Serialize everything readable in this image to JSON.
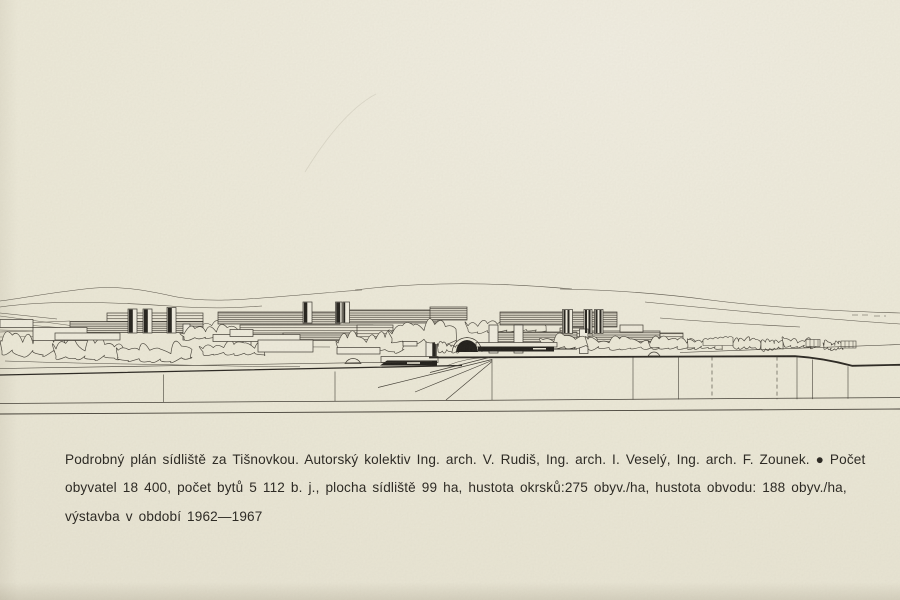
{
  "page": {
    "kind": "book page with architectural drawing",
    "drawing_alt": "Panoramic line drawing of a housing estate: long slab apartment blocks and striped tower blocks among trees, hills in the background, elevated road and retaining wall in the foreground",
    "caption": {
      "line1": "Podrobný plán sídliště za Tišnovkou. Autorský kolektiv Ing. arch. V. Rudiš, Ing. arch. I. Veselý, Ing. arch. F. Zounek. ● Počet",
      "line2": "obyvatel 18 400, počet bytů 5 112 b. j., plocha sídliště 99 ha, hustota okrsků:275 obyv./ha, hustota obvodu: 188 obyv./ha,",
      "line3": "výstavba v období 1962—1967"
    },
    "colors": {
      "paper": "#edead9",
      "ink": "#3a362e"
    }
  }
}
